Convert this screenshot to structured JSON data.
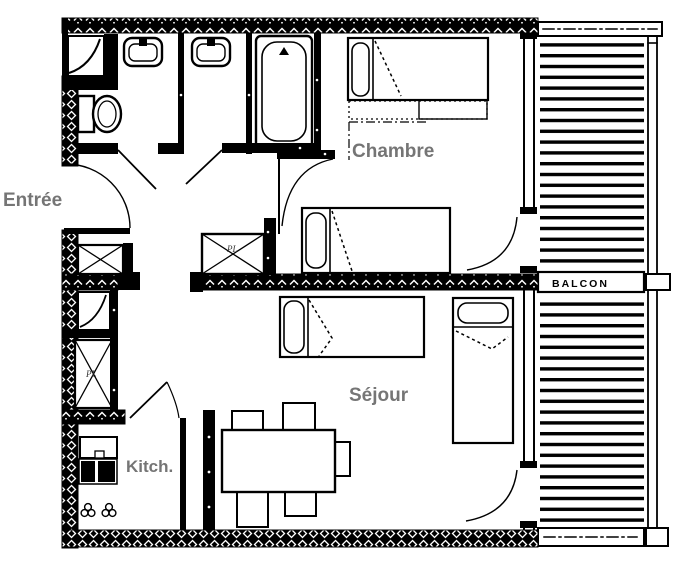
{
  "plan": {
    "labels": {
      "entree": "Entrée",
      "chambre": "Chambre",
      "sejour": "Séjour",
      "kitchen": "Kitch.",
      "balcony": "BALCON",
      "closet_hall": "PL",
      "closet_corridor": "PL"
    },
    "colors": {
      "wall": "#000000",
      "room_label": "#757575",
      "balcony_label": "#000000",
      "background": "#ffffff"
    }
  }
}
